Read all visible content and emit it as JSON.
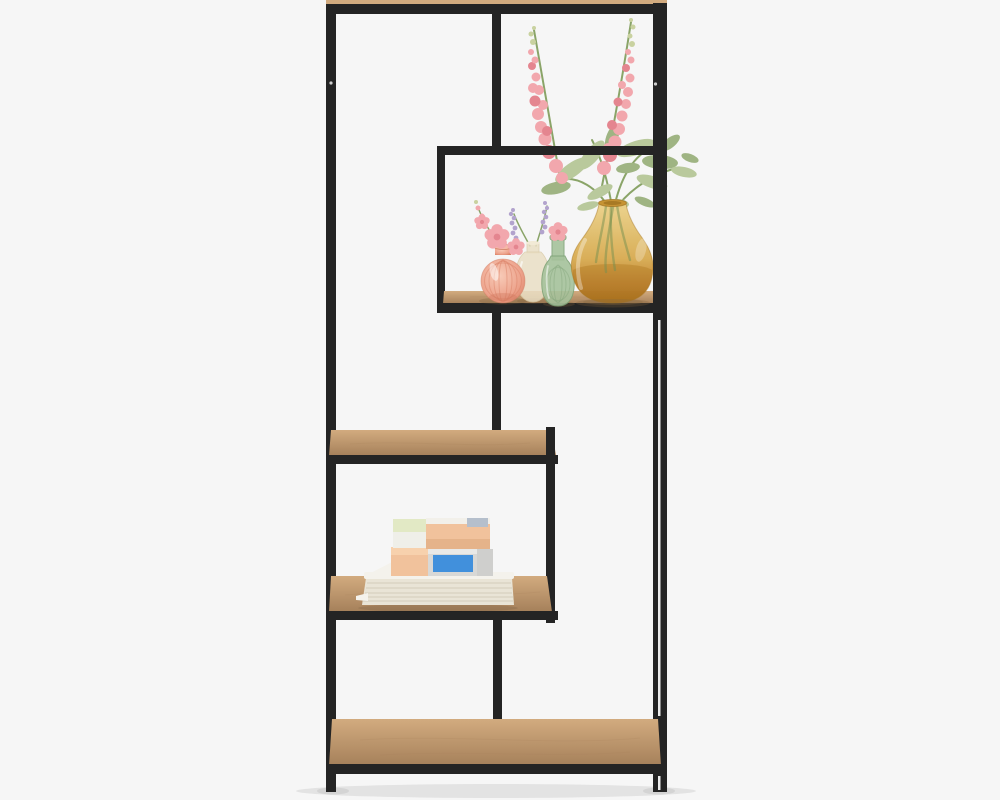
{
  "scene": {
    "type": "studio-product-photo",
    "subject": "tall black metal asymmetric shelving unit with oak-look shelves",
    "items": [
      "suspended display cube holding four glass vases with faux flowers",
      "pink delphinium flower stems with sage greenery rising from amber vase",
      "stack of magazines topped with pastel storage boxes on lower shelf",
      "five staggered wooden shelf panels in black square-tube frame"
    ]
  },
  "colors": {
    "background": "#f6f6f6",
    "frame": "#242424",
    "frame_seam": "#ececec",
    "wood_light": "#d2ab7f",
    "wood_mid": "#c29a6d",
    "wood_dark": "#a5805a",
    "vase_coral": "#eda38c",
    "vase_coral_deep": "#d97f63",
    "vase_clear": "#eadfc5",
    "vase_green": "#a6c29c",
    "vase_green_deep": "#7fa377",
    "vase_amber_light": "#ecd28a",
    "vase_amber": "#d8ac52",
    "vase_amber_deep": "#c28434",
    "vase_amber_base": "#a87020",
    "flower_pink": "#f2a7ad",
    "flower_pink_deep": "#e4858f",
    "flower_bud_green": "#c9d2a0",
    "lavender": "#b2a3cd",
    "leaf": "#b9c99c",
    "leaf_dark": "#9fb483",
    "stem": "#8aa468",
    "magazine": "#e9e4d6",
    "magazine_line": "#d2ccba",
    "paper_white": "#f4f2ec",
    "box_peach": "#f1c29c",
    "box_peach_deep": "#e5b38a",
    "box_blue": "#4190dc",
    "box_gray": "#d8d8d6",
    "box_green_top": "#e2e9c5",
    "box_white": "#efefe9",
    "box_bluegray": "#b5bfcc"
  }
}
